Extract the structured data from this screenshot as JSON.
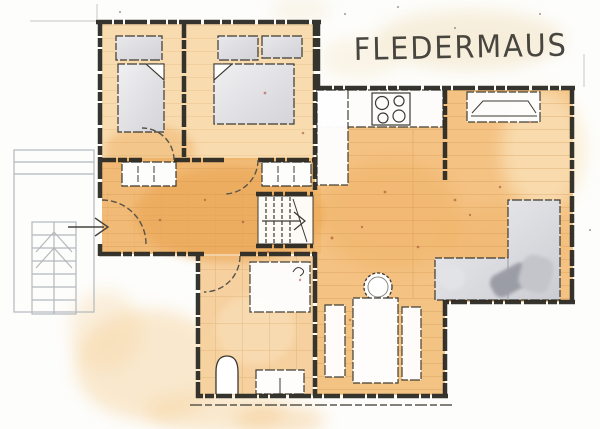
{
  "title": "FLEDERMAUS",
  "plan": {
    "type": "hand-drawn watercolor floor plan",
    "rooms": [
      {
        "name": "bedroom-1"
      },
      {
        "name": "bedroom-2"
      },
      {
        "name": "hall"
      },
      {
        "name": "stairwell"
      },
      {
        "name": "bathroom"
      },
      {
        "name": "kitchen"
      },
      {
        "name": "living-room"
      },
      {
        "name": "dining-area"
      },
      {
        "name": "exterior-staircase"
      }
    ],
    "furniture": [
      "wardrobe",
      "single-bed",
      "double-wardrobe",
      "double-bed",
      "hall-closets",
      "kitchen-counter",
      "stove-hob",
      "sideboard",
      "l-shaped-sofa",
      "round-stove",
      "dining-table",
      "bench",
      "bench",
      "shower",
      "toilet",
      "washbasin"
    ],
    "annotations": {
      "entrance_arrow": "points right into entrance door",
      "interior_stairs_arrow": "points right",
      "exterior_stairs_arrows": "chevrons point up"
    }
  },
  "colors": {
    "floor_orange": "#f0b267",
    "floor_light": "#f7d9a8",
    "wall_ink": "#2b2a24",
    "furniture_grey": "#dcdce0",
    "sketch_grey": "#b7bbc0",
    "speckle": "#a0452f",
    "paper": "#fdfdfb"
  }
}
